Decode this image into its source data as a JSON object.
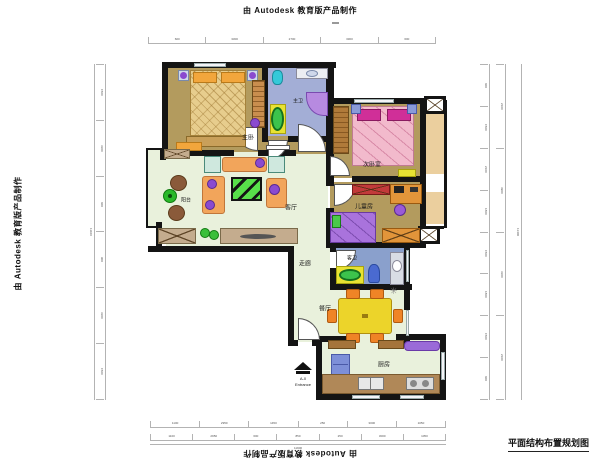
{
  "branding": {
    "top": "由 Autodesk 教育版产品制作",
    "left": "由 Autodesk 教育版产品制作",
    "bottom": "由 Autodesk 教育版产品制作"
  },
  "drawing_title": "平面结构布置规划图",
  "rooms": {
    "master_bedroom": "主卧",
    "master_bath": "主卫",
    "second_bedroom": "次卧室",
    "kids_room": "儿童房",
    "living_room": "客厅",
    "balcony": "阳台",
    "corridor": "走廊",
    "guest_bath": "客卫",
    "dining_room": "餐厅",
    "kitchen": "厨房"
  },
  "entrance": {
    "code": "A-0",
    "label": "Entrance"
  },
  "icons": {
    "sun_decoration": "✳",
    "entrance_arrow": "solid black arrow with base bar"
  },
  "colors": {
    "wall": "#141414",
    "floor_tan": "#b39b5e",
    "floor_green": "#e9f1dc",
    "floor_bath_master": "#a3aed6",
    "floor_bath_guest": "#8aa0cc",
    "balcony_tan": "#ebcf9e",
    "bed_master": "#e7cd8d",
    "pillow_orange": "#f2a63c",
    "bed_pink": "#f2bacc",
    "pillow_magenta": "#d02f98",
    "bed_kids": "#a973dc",
    "sofa_orange": "#f2a55b",
    "rug_green": "#58e04a",
    "table_yellow": "#ecd42a",
    "chair_orange": "#ef8426",
    "counter_brown": "#b08858",
    "cabinet_tan": "#c4ac8e",
    "fridge_blue": "#7d8fd8",
    "tub_green": "#3cc34c",
    "mat_yellow": "#e8e233",
    "fixture_cyan": "#35c9d9",
    "shower_purple": "#b78ae0",
    "cushion_purple": "#8a4ad0",
    "wardrobe_brown": "#c98e4e"
  },
  "dimensions": {
    "top": [
      "600",
      "3300",
      "2700",
      "3300",
      "600"
    ],
    "bottom_row1": [
      "1100",
      "2950",
      "1450",
      "250",
      "3000",
      "1050"
    ],
    "bottom_row2": [
      "1100",
      "2950",
      "600",
      "850",
      "250",
      "3000",
      "1050"
    ],
    "bottom_total": "11900",
    "left": [
      "1500",
      "3300",
      "600",
      "900",
      "3300",
      "1500"
    ],
    "left_total": "11100",
    "right_inner": [
      "600",
      "1500",
      "2100",
      "1800",
      "1500",
      "1800",
      "1500",
      "600"
    ],
    "right_mid": [
      "2100",
      "3900",
      "3300",
      "2100"
    ],
    "right_total": "11400"
  }
}
